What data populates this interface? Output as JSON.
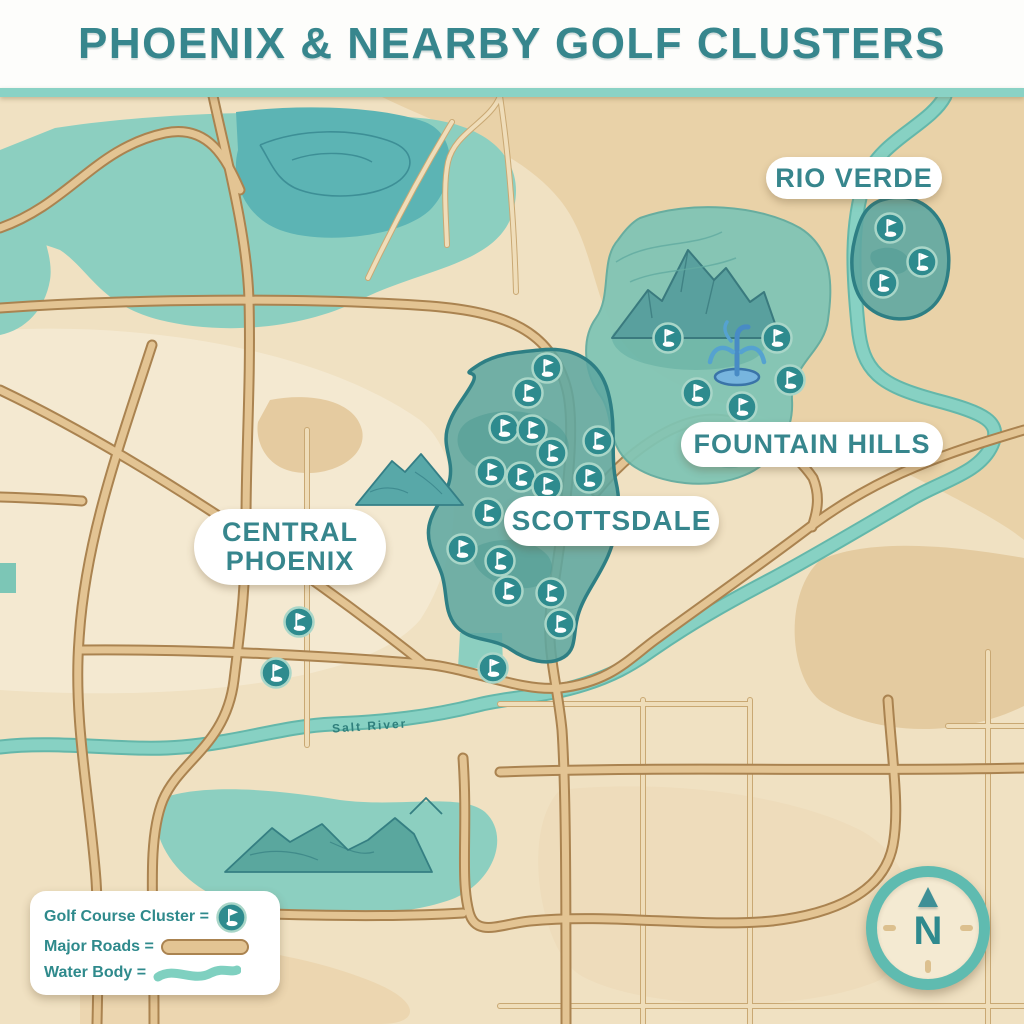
{
  "header": {
    "title": "PHOENIX & NEARBY GOLF CLUSTERS"
  },
  "map": {
    "labels": {
      "rio_verde": "RIO VERDE",
      "fountain_hills": "FOUNTAIN HILLS",
      "scottsdale": "SCOTTSDALE",
      "central_phoenix_line1": "CENTRAL",
      "central_phoenix_line2": "PHOENIX",
      "river": "Salt River"
    },
    "compass": {
      "label": "N"
    },
    "clusters": [
      {
        "name": "Scottsdale",
        "markers": [
          [
            547,
            368
          ],
          [
            528,
            393
          ],
          [
            504,
            428
          ],
          [
            532,
            430
          ],
          [
            552,
            453
          ],
          [
            598,
            441
          ],
          [
            491,
            472
          ],
          [
            521,
            477
          ],
          [
            547,
            486
          ],
          [
            589,
            478
          ],
          [
            488,
            513
          ],
          [
            462,
            549
          ],
          [
            500,
            561
          ],
          [
            508,
            591
          ],
          [
            551,
            593
          ],
          [
            560,
            624
          ]
        ]
      },
      {
        "name": "Fountain Hills",
        "markers": [
          [
            668,
            338
          ],
          [
            777,
            338
          ],
          [
            790,
            380
          ],
          [
            697,
            393
          ],
          [
            742,
            407
          ]
        ]
      },
      {
        "name": "Rio Verde",
        "markers": [
          [
            890,
            228
          ],
          [
            922,
            262
          ],
          [
            883,
            283
          ]
        ]
      },
      {
        "name": "Central Phoenix",
        "markers": [
          [
            299,
            622
          ],
          [
            276,
            673
          ]
        ]
      },
      {
        "name": "South Scottsdale",
        "markers": [
          [
            493,
            668
          ]
        ]
      }
    ]
  },
  "legend": {
    "rows": [
      {
        "label": "Golf Course Cluster =",
        "symbol": "golf-cluster-icon"
      },
      {
        "label": "Major Roads =",
        "symbol": "road-swatch"
      },
      {
        "label": "Water Body =",
        "symbol": "water-swatch"
      }
    ]
  },
  "colors": {
    "title_teal": "#37868d",
    "header_strip": "#8ad2c5",
    "map_base": "#f0e1c2",
    "sand_dark": "#e7cfa4",
    "sand_light": "#f6ecd7",
    "water_teal": "#8ccfc0",
    "water_dark": "#5cb4b4",
    "cluster_fill": "#5fa7a1",
    "cluster_border": "#2e7f84",
    "marker_fill": "#2e8b8e",
    "road_fill": "#e3c493",
    "road_border": "#aa8350",
    "river": "#87d1c3",
    "fountain_blue": "#4a9fd4"
  }
}
